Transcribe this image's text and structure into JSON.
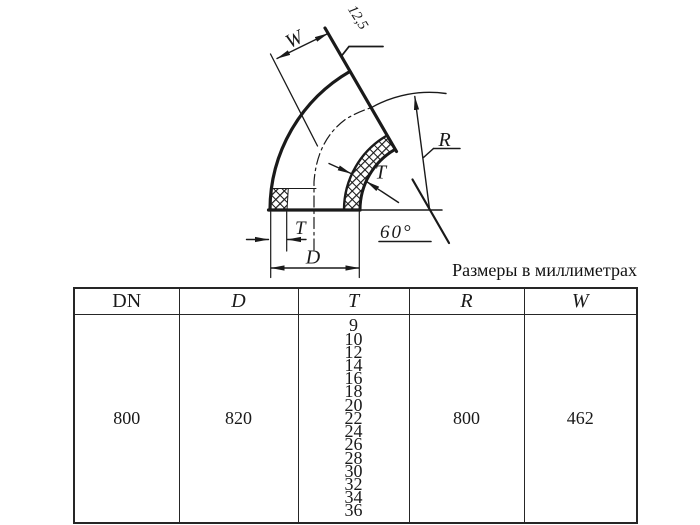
{
  "page": {
    "background": "#ffffff",
    "ink": "#1a1a1a"
  },
  "caption": "Размеры в миллиметрах",
  "drawing": {
    "description": "Sectioned 60-degree pipe elbow with dimension callouts",
    "labels": {
      "width_dim": "W",
      "roughness": "12,5",
      "radius_dim": "R",
      "wall_thickness_top": "T",
      "angle": "60°",
      "wall_thickness_bottom": "T",
      "outer_diameter_dim": "D"
    }
  },
  "table": {
    "headers": [
      "DN",
      "D",
      "T",
      "R",
      "W"
    ],
    "row": {
      "dn": "800",
      "d": "820",
      "t_values": [
        "9",
        "10",
        "12",
        "14",
        "16",
        "18",
        "20",
        "22",
        "24",
        "26",
        "28",
        "30",
        "32",
        "34",
        "36"
      ],
      "r": "800",
      "w": "462"
    }
  }
}
